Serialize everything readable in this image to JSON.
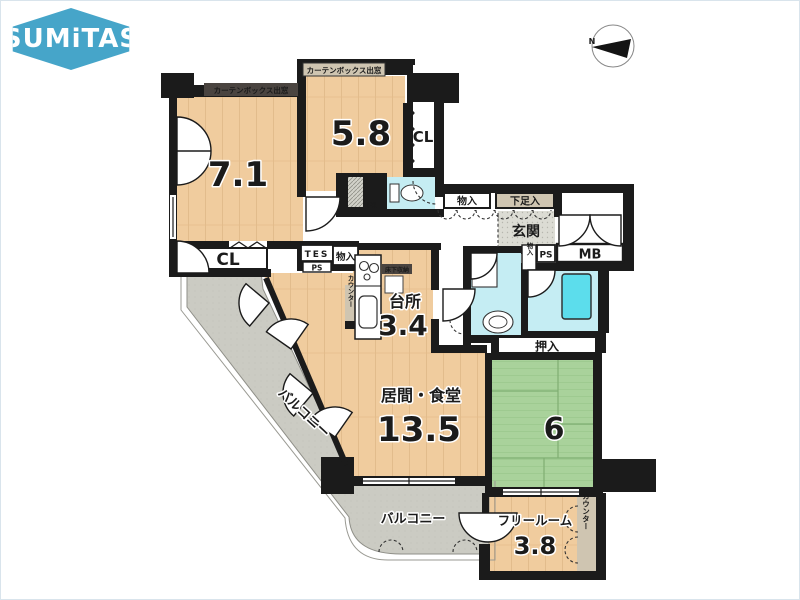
{
  "brand": {
    "name": "SUMiTAS"
  },
  "compass": {
    "north": "N"
  },
  "plan": {
    "bedroom1": {
      "size": "7.1",
      "window": "カーテンボックス出窓"
    },
    "bedroom2": {
      "size": "5.8",
      "window": "カーテンボックス出窓"
    },
    "living": {
      "name": "居間・食堂",
      "size": "13.5"
    },
    "kitchen": {
      "name": "台所",
      "size": "3.4",
      "underfloor": "床下収納",
      "counter": "カウンター"
    },
    "tatami": {
      "size": "6"
    },
    "free_room": {
      "name": "フリールーム",
      "size": "3.8",
      "counter": "カウンター"
    },
    "entrance": {
      "name": "玄関",
      "shoe_box": "下足入"
    },
    "closets": {
      "cl_upper": "CL",
      "cl_lower": "CL",
      "oshiire": "押入",
      "monoire_hall": "物入",
      "monoire_left": "物入",
      "monoire_small": "物入"
    },
    "utility": {
      "mb": "MB",
      "tes": "TES",
      "ps_tes": "PS",
      "ps_toilet": "PS",
      "ps_entry": "PS"
    },
    "balconies": {
      "left": "バルコニー",
      "bottom": "バルコニー"
    }
  },
  "colors": {
    "brand_teal": "#46a5c9",
    "wood": "#f0cc9e",
    "tatami_green": "#a9d29b",
    "water_cyan": "#c5edf3",
    "bathtub_cyan": "#5cddec",
    "balcony_gray": "#cbcbc3",
    "wall_black": "#1b1b1b",
    "tan": "#cfc5b1"
  }
}
